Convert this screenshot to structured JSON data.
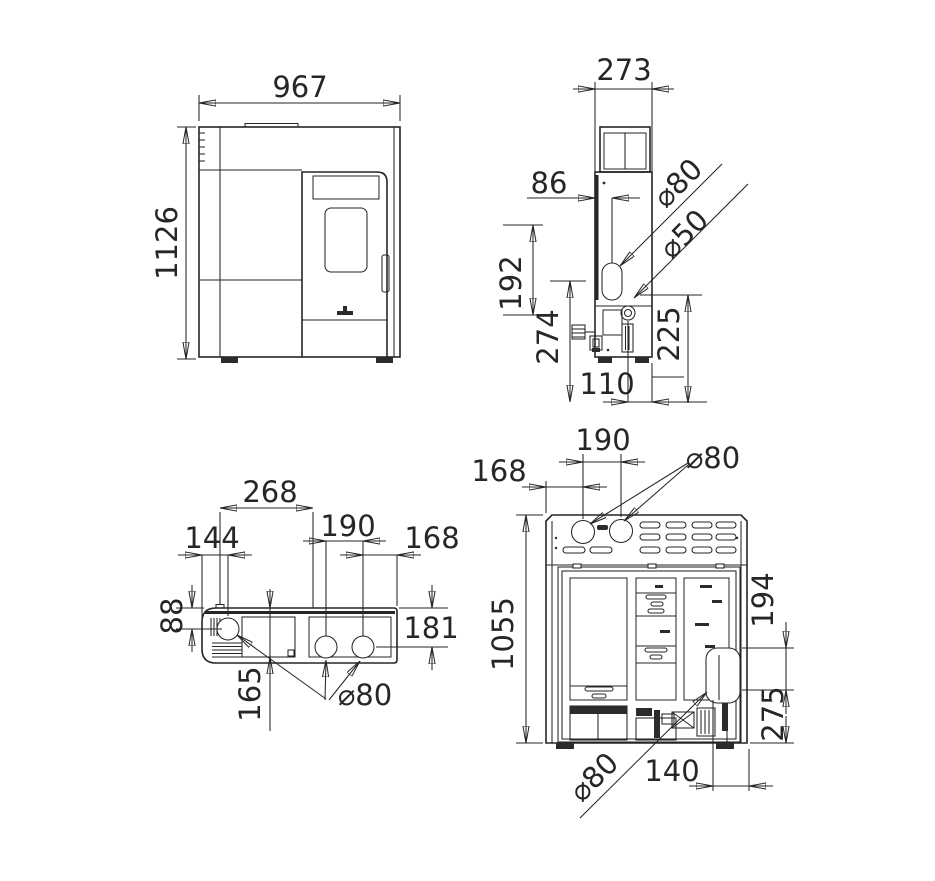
{
  "title": "pellet-stove-dimension-drawing",
  "colors": {
    "background": "#ffffff",
    "line": "#262626"
  },
  "views": {
    "front": {
      "label": "front-view",
      "width": "967",
      "height": "1126"
    },
    "side": {
      "label": "side-view",
      "depth": "273",
      "rear_to_flue": "86",
      "flue_vertical": "192",
      "flue_bottom_height": "274",
      "air_inlet_height": "225",
      "air_to_front": "110",
      "flue_diameter": "⌀80",
      "air_diameter": "⌀50"
    },
    "top": {
      "label": "top-view",
      "lid_width": "268",
      "outlet_spacing": "190",
      "edge_to_flue": "144",
      "outlet_to_edge": "168",
      "rear_to_flue": "88",
      "rear_to_outlets": "181",
      "rear_to_lid": "165",
      "outlet_diameter": "⌀80"
    },
    "rear": {
      "label": "rear-view",
      "outlet_spacing": "190",
      "edge_to_outlet": "168",
      "outlet_diameter": "⌀80",
      "height": "1055",
      "cutout_height": "194",
      "flue_height": "275",
      "flue_to_edge": "140",
      "flue_diameter": "⌀80"
    }
  }
}
